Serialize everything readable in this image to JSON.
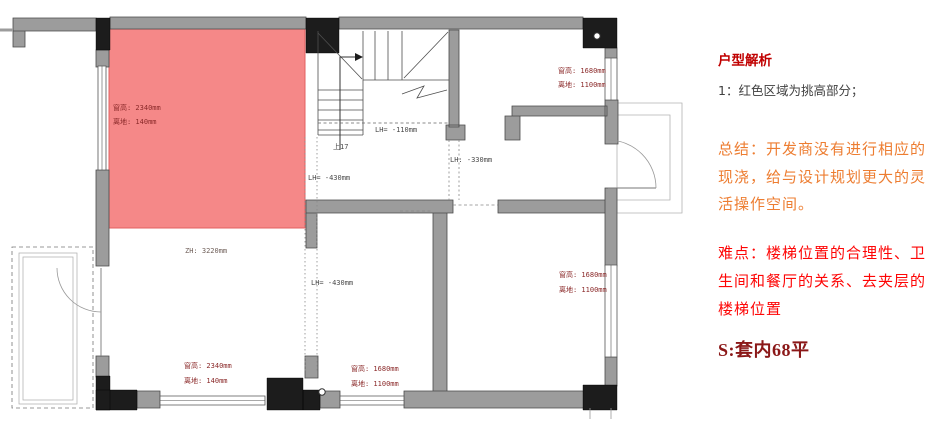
{
  "panel": {
    "title": "户型解析",
    "point1": "1：红色区域为挑高部分；",
    "summary_lines": [
      "总结：开发商没有进行相应的",
      "现浇，给与设计规划更大的灵",
      "活操作空间。"
    ],
    "difficulty_lines": [
      "难点：楼梯位置的合理性、卫",
      "生间和餐厅的关系、去夹层的",
      "楼梯位置"
    ],
    "area": "S:套内68平",
    "colors": {
      "title": "#c00000",
      "body": "#404040",
      "summary": "#ed7d31",
      "difficulty": "#fe0505",
      "area": "#8b1818"
    }
  },
  "plan": {
    "colors": {
      "highlight": "#f58888",
      "highlight_border": "#e26060",
      "dim_label": "#8b2a2a",
      "level_label": "#4a4a4a",
      "zh_label": "#70605a"
    },
    "labels": {
      "red_win_h": "窗高: 2340mm",
      "red_win_sill": "离地: 140mm",
      "zh": "ZH: 3220mm",
      "lh430a": "LH= -430mm",
      "lh430b": "LH= -430mm",
      "lh110": "LH= -110mm",
      "lh330": "LH: -330mm",
      "up17": "上17",
      "tr_win_h": "窗高: 1680mm",
      "tr_win_sill": "离地: 1100mm",
      "midr_win_h": "窗高: 1680mm",
      "midr_win_sill": "离地: 1100mm",
      "bl_win_h": "窗高: 2340mm",
      "bl_win_sill": "离地: 140mm",
      "bm_win_h": "窗高: 1680mm",
      "bm_win_sill": "离地: 1100mm"
    }
  }
}
